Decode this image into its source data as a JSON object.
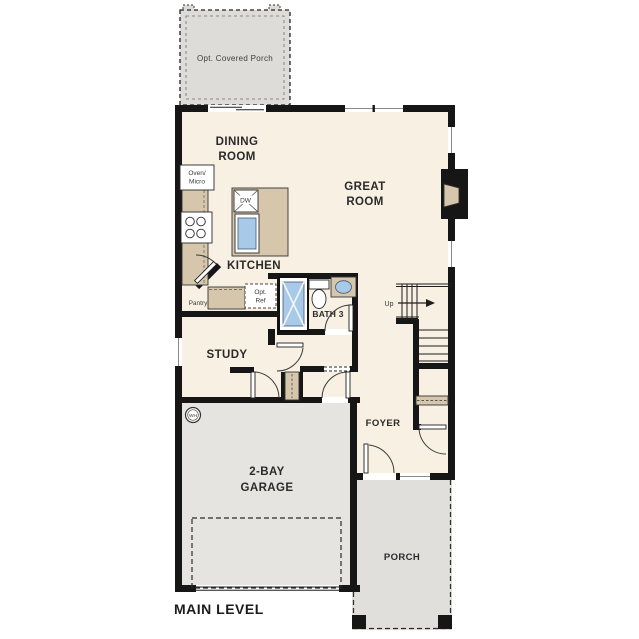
{
  "plan_title": "MAIN LEVEL",
  "labels": {
    "opt_porch": "Opt. Covered Porch",
    "dining_line1": "DINING",
    "dining_line2": "ROOM",
    "great_line1": "GREAT",
    "great_line2": "ROOM",
    "kitchen": "KITCHEN",
    "oven_line1": "Oven/",
    "oven_line2": "Micro",
    "dw": "DW",
    "pantry": "Pantry",
    "opt_ref_line1": "Opt.",
    "opt_ref_line2": "Ref",
    "bath3": "BATH 3",
    "up": "Up",
    "study": "STUDY",
    "foyer": "FOYER",
    "wh": "WH",
    "garage_line1": "2-BAY",
    "garage_line2": "GARAGE",
    "porch": "PORCH"
  },
  "colors": {
    "wall": "#161616",
    "floor": "#f8f0e2",
    "garage_floor": "#e5e4e0",
    "porch_floor": "#e0dfdb",
    "opt_porch_floor": "#dddcd8",
    "counter": "#d6c6ab",
    "fixture_blue": "#a9c9e9",
    "label_text": "#2a2a2a"
  }
}
